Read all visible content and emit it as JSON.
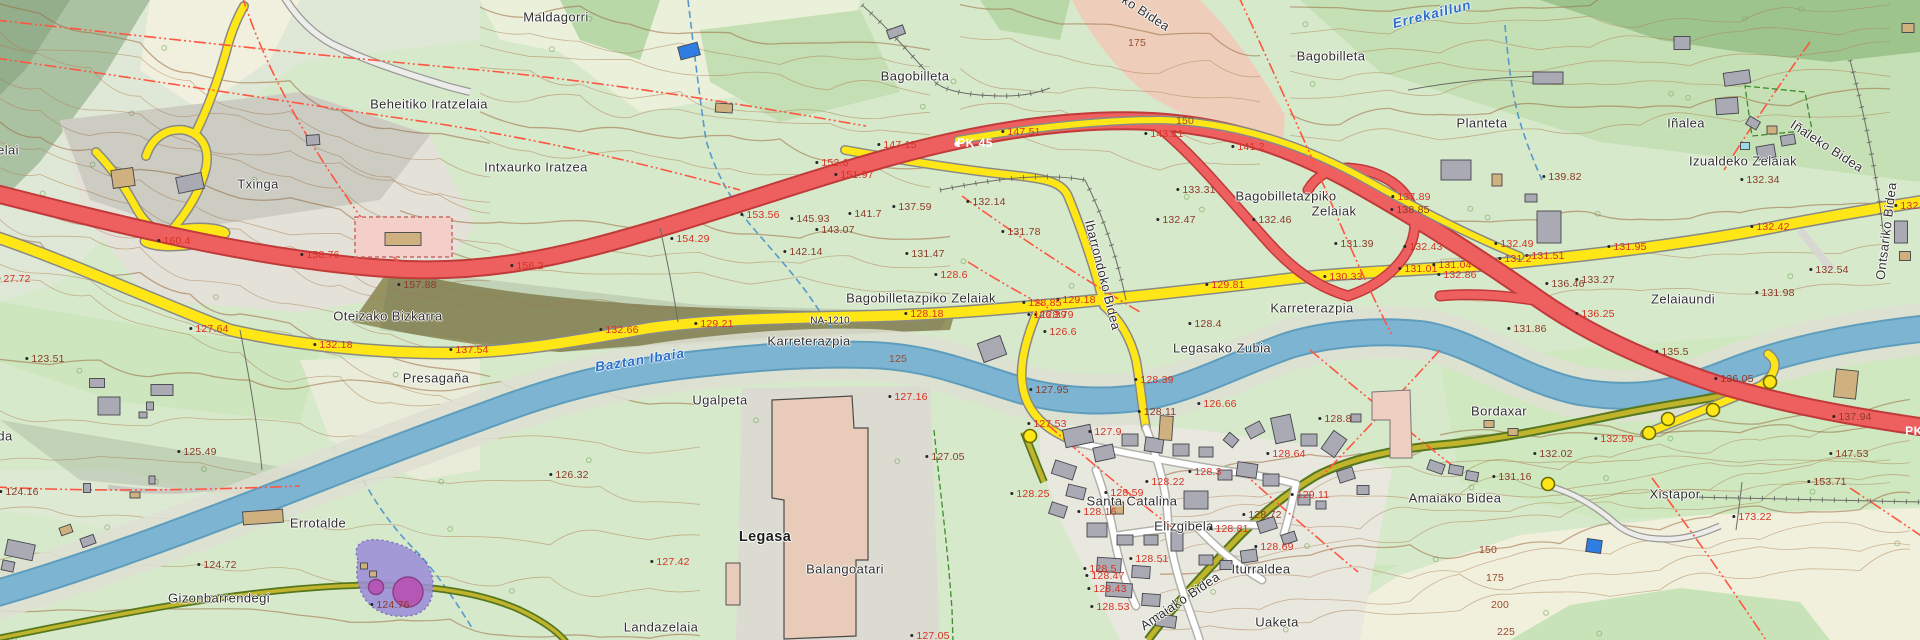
{
  "map": {
    "width": 1920,
    "height": 640,
    "description": "Topographic cadastral map of Legasa area (Bertizarana) with Baztan river, N-road and local roads"
  },
  "colors": {
    "field_green": "#d7e9cb",
    "wood_green": "#b9d8a8",
    "dark_wood": "#9dc48d",
    "bare_cream": "#f1f0de",
    "bare_gray": "#e4e2d8",
    "scarp_olive": "#8f8c59",
    "river_blue": "#7db4d2",
    "river_edge": "#5e9dbd",
    "highway_red": "#ee6060",
    "highway_casing": "#c13a3a",
    "road_yellow": "#ffe617",
    "track_olive": "#c0b42c",
    "track_casing": "#55771f",
    "street_white": "#ffffff",
    "building_gray": "#aaaab4",
    "building_tan": "#cfb180",
    "building_blue": "#2f7de1",
    "factory_salmon": "#e9cbba",
    "parcel_pink": "#f2c9b9",
    "boundary_red": "#ff5540",
    "contour_brown": "#ad7d52",
    "facility_purple": "#9b8fd8",
    "facility_magenta": "#b558b5",
    "spot_dark": "#8a3a28",
    "spot_red": "#d63222",
    "water_label_blue": "#2e6fc4"
  },
  "legend_classes": {
    "p": "place-name",
    "pb": "town-name-bold",
    "e": "spot-elevation-dark",
    "er": "spot-elevation-red",
    "c": "contour-elevation",
    "w": "water-name",
    "rw": "road-kilometer-marker",
    "rn": "road-reference"
  },
  "labels": [
    [
      "elai",
      8,
      150,
      "p",
      0
    ],
    [
      "Beheitiko Iratzelaia",
      429,
      104,
      "p",
      0
    ],
    [
      "Maldagorri",
      556,
      17,
      "p",
      0
    ],
    [
      "Bagobilleta",
      915,
      76,
      "p",
      0
    ],
    [
      "Bagobilleta",
      1331,
      56,
      "p",
      0
    ],
    [
      "Errekaillun",
      1432,
      14,
      "w",
      -14
    ],
    [
      "ko Bidea",
      1146,
      13,
      "p",
      33
    ],
    [
      "Planteta",
      1482,
      123,
      "p",
      0
    ],
    [
      "Iñalea",
      1686,
      123,
      "p",
      0
    ],
    [
      "Izualdeko Zelaiak",
      1743,
      161,
      "p",
      0
    ],
    [
      "Iñaleko Bidea",
      1827,
      146,
      "p",
      33
    ],
    [
      "Txinga",
      258,
      184,
      "p",
      0
    ],
    [
      "Intxaurko Iratzea",
      536,
      167,
      "p",
      0
    ],
    [
      "Oteizako Bizkarra",
      388,
      316,
      "p",
      0
    ],
    [
      "Presagaña",
      436,
      378,
      "p",
      0
    ],
    [
      "Bagobilletazpiko Zelaiak",
      921,
      298,
      "p",
      0
    ],
    [
      "Karreterazpia",
      809,
      341,
      "p",
      0
    ],
    [
      "NA-1210",
      830,
      321,
      "rn",
      0
    ],
    [
      "Baztan Ibaia",
      640,
      360,
      "w",
      -9
    ],
    [
      "Ugalpeta",
      720,
      400,
      "p",
      0
    ],
    [
      "Karreterazpia",
      1312,
      308,
      "p",
      0
    ],
    [
      "Legasako Zubia",
      1222,
      348,
      "p",
      0
    ],
    [
      "Bagobilletazpiko",
      1286,
      196,
      "p",
      0
    ],
    [
      "Zelaiak",
      1334,
      211,
      "p",
      0
    ],
    [
      "Zelaiaundi",
      1683,
      299,
      "p",
      0
    ],
    [
      "Ontsariko Bidea",
      1886,
      231,
      "p",
      -83
    ],
    [
      "Ibarrondoko Bidea",
      1103,
      275,
      "p",
      76
    ],
    [
      "Bordaxar",
      1499,
      411,
      "p",
      0
    ],
    [
      "Errotalde",
      318,
      523,
      "p",
      0
    ],
    [
      "Gizonbarrendegi",
      219,
      598,
      "p",
      0
    ],
    [
      "Legasa",
      765,
      537,
      "pb",
      0
    ],
    [
      "Balangoatari",
      845,
      569,
      "p",
      0
    ],
    [
      "Landazelaia",
      661,
      627,
      "p",
      0
    ],
    [
      "Santa Catalina",
      1132,
      501,
      "p",
      0
    ],
    [
      "Elizgibela",
      1184,
      526,
      "p",
      0
    ],
    [
      "Iturraldea",
      1261,
      569,
      "p",
      0
    ],
    [
      "Amaiako Bidea",
      1180,
      601,
      "p",
      -34
    ],
    [
      "Amaiako Bidea",
      1455,
      498,
      "p",
      0
    ],
    [
      "Uaketa",
      1277,
      622,
      "p",
      0
    ],
    [
      "Xistapor",
      1675,
      494,
      "p",
      0
    ],
    [
      "da",
      5,
      436,
      "p",
      0
    ],
    [
      "27.72",
      14,
      279,
      "er",
      0
    ],
    [
      "123.51",
      45,
      359,
      "e",
      0
    ],
    [
      "127.64",
      209,
      329,
      "er",
      0
    ],
    [
      "132.18",
      333,
      345,
      "er",
      0
    ],
    [
      "137.54",
      469,
      350,
      "er",
      0
    ],
    [
      "125.49",
      197,
      452,
      "e",
      0
    ],
    [
      "124.16",
      19,
      492,
      "e",
      0
    ],
    [
      "124.72",
      217,
      565,
      "e",
      0
    ],
    [
      "124.76",
      390,
      605,
      "e",
      0
    ],
    [
      "160.4",
      174,
      241,
      "er",
      0
    ],
    [
      "158.76",
      320,
      255,
      "er",
      0
    ],
    [
      "157.88",
      417,
      285,
      "e",
      0
    ],
    [
      "156.2",
      527,
      266,
      "er",
      0
    ],
    [
      "154.29",
      690,
      239,
      "er",
      0
    ],
    [
      "153.56",
      760,
      215,
      "er",
      0
    ],
    [
      "152.6",
      832,
      163,
      "er",
      0
    ],
    [
      "151.97",
      854,
      175,
      "er",
      0
    ],
    [
      "145.93",
      810,
      219,
      "e",
      0
    ],
    [
      "143.07",
      835,
      230,
      "e",
      0
    ],
    [
      "142.14",
      803,
      252,
      "e",
      0
    ],
    [
      "141.7",
      865,
      214,
      "e",
      0
    ],
    [
      "137.59",
      912,
      207,
      "e",
      0
    ],
    [
      "131.47",
      925,
      254,
      "e",
      0
    ],
    [
      "128.18",
      924,
      314,
      "er",
      0
    ],
    [
      "128.6",
      951,
      275,
      "er",
      0
    ],
    [
      "147.15",
      897,
      145,
      "er",
      0
    ],
    [
      "PK 45",
      975,
      143,
      "rw",
      0
    ],
    [
      "147.51",
      1021,
      132,
      "er",
      0
    ],
    [
      "143.21",
      1164,
      134,
      "er",
      0
    ],
    [
      "141.2",
      1248,
      147,
      "er",
      0
    ],
    [
      "175",
      1137,
      43,
      "c",
      0
    ],
    [
      "150",
      1185,
      121,
      "c",
      0
    ],
    [
      "132.14",
      986,
      202,
      "e",
      0
    ],
    [
      "131.78",
      1021,
      232,
      "e",
      0
    ],
    [
      "133.31",
      1196,
      190,
      "e",
      0
    ],
    [
      "132.47",
      1176,
      220,
      "e",
      0
    ],
    [
      "132.46",
      1272,
      220,
      "e",
      0
    ],
    [
      "131.39",
      1354,
      244,
      "e",
      0
    ],
    [
      "137.89",
      1411,
      197,
      "er",
      0
    ],
    [
      "138.85",
      1410,
      210,
      "e",
      0
    ],
    [
      "132.43",
      1423,
      247,
      "er",
      0
    ],
    [
      "131.01",
      1418,
      269,
      "er",
      0
    ],
    [
      "130.33",
      1343,
      277,
      "er",
      0
    ],
    [
      "129.81",
      1225,
      285,
      "er",
      0
    ],
    [
      "129.18",
      1076,
      300,
      "er",
      0
    ],
    [
      "128.85",
      1042,
      303,
      "er",
      0
    ],
    [
      "128.79",
      1054,
      315,
      "er",
      0
    ],
    [
      "139.82",
      1562,
      177,
      "e",
      0
    ],
    [
      "132.34",
      1760,
      180,
      "e",
      0
    ],
    [
      "132.42",
      1770,
      227,
      "er",
      0
    ],
    [
      "131.95",
      1627,
      247,
      "er",
      0
    ],
    [
      "131.51",
      1545,
      256,
      "er",
      0
    ],
    [
      "131.2",
      1515,
      259,
      "er",
      0
    ],
    [
      "132.49",
      1514,
      244,
      "er",
      0
    ],
    [
      "131.04",
      1452,
      265,
      "er",
      0
    ],
    [
      "132.86",
      1457,
      275,
      "er",
      0
    ],
    [
      "133.27",
      1595,
      280,
      "e",
      0
    ],
    [
      "136.46",
      1565,
      284,
      "e",
      0
    ],
    [
      "136.25",
      1595,
      314,
      "er",
      0
    ],
    [
      "131.98",
      1775,
      293,
      "e",
      0
    ],
    [
      "132.54",
      1829,
      270,
      "e",
      0
    ],
    [
      "132.4",
      1911,
      206,
      "er",
      0
    ],
    [
      "132.66",
      619,
      330,
      "er",
      0
    ],
    [
      "129.21",
      714,
      324,
      "er",
      0
    ],
    [
      "125",
      898,
      359,
      "c",
      0
    ],
    [
      "127.16",
      908,
      397,
      "er",
      0
    ],
    [
      "127.05",
      945,
      457,
      "e",
      0
    ],
    [
      "126.32",
      569,
      475,
      "e",
      0
    ],
    [
      "128.4",
      1205,
      324,
      "e",
      0
    ],
    [
      "126.6",
      1060,
      332,
      "er",
      0
    ],
    [
      "126.39",
      1047,
      315,
      "er",
      0
    ],
    [
      "128.39",
      1154,
      380,
      "er",
      0
    ],
    [
      "127.95",
      1049,
      390,
      "e",
      0
    ],
    [
      "126.66",
      1217,
      404,
      "er",
      0
    ],
    [
      "128.11",
      1157,
      412,
      "e",
      0
    ],
    [
      "127.53",
      1047,
      424,
      "er",
      0
    ],
    [
      "127.9",
      1105,
      432,
      "er",
      0
    ],
    [
      "128.8",
      1335,
      419,
      "e",
      0
    ],
    [
      "128.3",
      1205,
      472,
      "er",
      0
    ],
    [
      "128.64",
      1286,
      454,
      "er",
      0
    ],
    [
      "131.86",
      1527,
      329,
      "e",
      0
    ],
    [
      "135.5",
      1672,
      352,
      "e",
      0
    ],
    [
      "136.05",
      1734,
      379,
      "e",
      0
    ],
    [
      "137.94",
      1852,
      417,
      "e",
      0
    ],
    [
      "147.53",
      1849,
      454,
      "e",
      0
    ],
    [
      "132.59",
      1614,
      439,
      "er",
      0
    ],
    [
      "132.02",
      1553,
      454,
      "e",
      0
    ],
    [
      "131.16",
      1512,
      477,
      "e",
      0
    ],
    [
      "PK",
      1914,
      431,
      "rw",
      0
    ],
    [
      "127.42",
      670,
      562,
      "er",
      0
    ],
    [
      "127.05",
      930,
      636,
      "er",
      0
    ],
    [
      "128.22",
      1165,
      482,
      "er",
      0
    ],
    [
      "128.25",
      1030,
      494,
      "er",
      0
    ],
    [
      "128.59",
      1124,
      493,
      "er",
      0
    ],
    [
      "128.16",
      1097,
      512,
      "er",
      0
    ],
    [
      "128.81",
      1229,
      529,
      "er",
      0
    ],
    [
      "128.72",
      1262,
      515,
      "e",
      0
    ],
    [
      "129.11",
      1310,
      495,
      "er",
      0
    ],
    [
      "128.69",
      1274,
      547,
      "er",
      0
    ],
    [
      "128.51",
      1149,
      559,
      "er",
      0
    ],
    [
      "128.5",
      1100,
      569,
      "er",
      0
    ],
    [
      "128.47",
      1105,
      576,
      "er",
      0
    ],
    [
      "128.43",
      1107,
      589,
      "er",
      0
    ],
    [
      "128.53",
      1110,
      607,
      "er",
      0
    ],
    [
      "153.71",
      1827,
      482,
      "e",
      0
    ],
    [
      "173.22",
      1752,
      517,
      "er",
      0
    ],
    [
      "150",
      1488,
      550,
      "c",
      0
    ],
    [
      "175",
      1495,
      578,
      "c",
      0
    ],
    [
      "200",
      1500,
      605,
      "c",
      0
    ],
    [
      "225",
      1506,
      632,
      "c",
      0
    ]
  ],
  "buildings": [
    [
      123,
      178,
      22,
      18,
      -8,
      "t"
    ],
    [
      190,
      183,
      26,
      16,
      -12,
      "g"
    ],
    [
      313,
      140,
      13,
      10,
      -5,
      "g"
    ],
    [
      403,
      239,
      36,
      13,
      0,
      "t"
    ],
    [
      689,
      51,
      20,
      13,
      -15,
      "b"
    ],
    [
      724,
      108,
      17,
      9,
      4,
      "t"
    ],
    [
      896,
      32,
      17,
      9,
      -20,
      "g"
    ],
    [
      1682,
      43,
      16,
      13,
      0,
      "g"
    ],
    [
      1548,
      78,
      30,
      12,
      0,
      "g"
    ],
    [
      1737,
      78,
      26,
      13,
      -8,
      "g"
    ],
    [
      1727,
      106,
      22,
      16,
      -4,
      "g"
    ],
    [
      1753,
      123,
      12,
      9,
      30,
      "g"
    ],
    [
      1772,
      130,
      10,
      8,
      0,
      "t"
    ],
    [
      1788,
      140,
      14,
      10,
      -10,
      "g"
    ],
    [
      1745,
      146,
      9,
      7,
      0,
      "c"
    ],
    [
      1766,
      152,
      18,
      13,
      -10,
      "g"
    ],
    [
      1908,
      28,
      12,
      9,
      0,
      "t"
    ],
    [
      1456,
      170,
      30,
      20,
      0,
      "g"
    ],
    [
      1497,
      180,
      10,
      12,
      0,
      "t"
    ],
    [
      1549,
      227,
      24,
      32,
      0,
      "g"
    ],
    [
      1531,
      198,
      12,
      8,
      0,
      "g"
    ],
    [
      1901,
      232,
      13,
      22,
      0,
      "g"
    ],
    [
      1905,
      256,
      11,
      9,
      0,
      "t"
    ],
    [
      1846,
      384,
      22,
      28,
      6,
      "t"
    ],
    [
      1356,
      418,
      10,
      8,
      0,
      "g"
    ],
    [
      1489,
      424,
      10,
      7,
      0,
      "t"
    ],
    [
      1513,
      432,
      10,
      7,
      0,
      "t"
    ],
    [
      1334,
      444,
      16,
      22,
      35,
      "g"
    ],
    [
      1436,
      467,
      16,
      10,
      20,
      "g"
    ],
    [
      1456,
      470,
      14,
      9,
      10,
      "g"
    ],
    [
      1472,
      476,
      12,
      9,
      10,
      "g"
    ],
    [
      97,
      383,
      15,
      9,
      0,
      "g"
    ],
    [
      162,
      390,
      22,
      11,
      0,
      "g"
    ],
    [
      109,
      406,
      22,
      18,
      0,
      "g"
    ],
    [
      150,
      406,
      7,
      8,
      0,
      "g"
    ],
    [
      143,
      415,
      8,
      6,
      0,
      "g"
    ],
    [
      87,
      488,
      7,
      9,
      0,
      "g"
    ],
    [
      135,
      495,
      10,
      6,
      0,
      "t"
    ],
    [
      152,
      480,
      6,
      8,
      0,
      "g"
    ],
    [
      66,
      530,
      12,
      8,
      -20,
      "t"
    ],
    [
      88,
      541,
      14,
      9,
      -20,
      "g"
    ],
    [
      20,
      550,
      28,
      16,
      12,
      "g"
    ],
    [
      8,
      566,
      12,
      10,
      12,
      "g"
    ],
    [
      263,
      517,
      40,
      13,
      -4,
      "t"
    ],
    [
      364,
      566,
      7,
      6,
      0,
      "t"
    ],
    [
      373,
      574,
      7,
      6,
      0,
      "t"
    ],
    [
      733,
      584,
      14,
      42,
      0,
      "s"
    ],
    [
      992,
      349,
      24,
      20,
      -20,
      "g"
    ],
    [
      1078,
      436,
      28,
      18,
      -12,
      "g"
    ],
    [
      1104,
      453,
      20,
      14,
      -12,
      "g"
    ],
    [
      1064,
      470,
      22,
      14,
      18,
      "g"
    ],
    [
      1076,
      492,
      18,
      12,
      14,
      "g"
    ],
    [
      1058,
      510,
      16,
      12,
      18,
      "g"
    ],
    [
      1130,
      440,
      16,
      12,
      0,
      "g"
    ],
    [
      1154,
      445,
      18,
      14,
      8,
      "g"
    ],
    [
      1181,
      450,
      16,
      12,
      0,
      "g"
    ],
    [
      1206,
      452,
      14,
      10,
      0,
      "g"
    ],
    [
      1166,
      428,
      13,
      24,
      4,
      "t"
    ],
    [
      1231,
      440,
      12,
      10,
      40,
      "g"
    ],
    [
      1255,
      430,
      16,
      12,
      -28,
      "g"
    ],
    [
      1283,
      429,
      20,
      26,
      -12,
      "g"
    ],
    [
      1309,
      440,
      16,
      12,
      0,
      "g"
    ],
    [
      1247,
      470,
      20,
      14,
      8,
      "g"
    ],
    [
      1271,
      480,
      16,
      12,
      0,
      "g"
    ],
    [
      1225,
      475,
      14,
      10,
      0,
      "g"
    ],
    [
      1117,
      508,
      13,
      12,
      0,
      "t"
    ],
    [
      1196,
      500,
      24,
      18,
      0,
      "g"
    ],
    [
      1097,
      530,
      20,
      14,
      0,
      "g"
    ],
    [
      1125,
      540,
      16,
      10,
      0,
      "g"
    ],
    [
      1151,
      540,
      14,
      10,
      0,
      "g"
    ],
    [
      1177,
      541,
      12,
      20,
      0,
      "g"
    ],
    [
      1109,
      565,
      24,
      14,
      4,
      "g"
    ],
    [
      1141,
      572,
      18,
      12,
      4,
      "g"
    ],
    [
      1119,
      590,
      26,
      14,
      4,
      "g"
    ],
    [
      1151,
      600,
      18,
      12,
      4,
      "g"
    ],
    [
      1166,
      621,
      20,
      12,
      8,
      "g"
    ],
    [
      1206,
      560,
      14,
      10,
      0,
      "g"
    ],
    [
      1226,
      565,
      12,
      9,
      0,
      "g"
    ],
    [
      1249,
      556,
      16,
      12,
      -8,
      "g"
    ],
    [
      1267,
      525,
      18,
      12,
      -18,
      "g"
    ],
    [
      1289,
      538,
      14,
      10,
      -18,
      "g"
    ],
    [
      1304,
      500,
      12,
      10,
      0,
      "g"
    ],
    [
      1321,
      505,
      10,
      8,
      0,
      "g"
    ],
    [
      1346,
      475,
      16,
      12,
      -18,
      "g"
    ],
    [
      1363,
      490,
      12,
      9,
      0,
      "g"
    ],
    [
      1594,
      546,
      15,
      13,
      8,
      "b"
    ]
  ],
  "trail_nodes": [
    [
      1548,
      484
    ],
    [
      1030,
      436
    ],
    [
      1649,
      433
    ],
    [
      1668,
      419
    ],
    [
      1713,
      410
    ],
    [
      1770,
      382
    ]
  ]
}
